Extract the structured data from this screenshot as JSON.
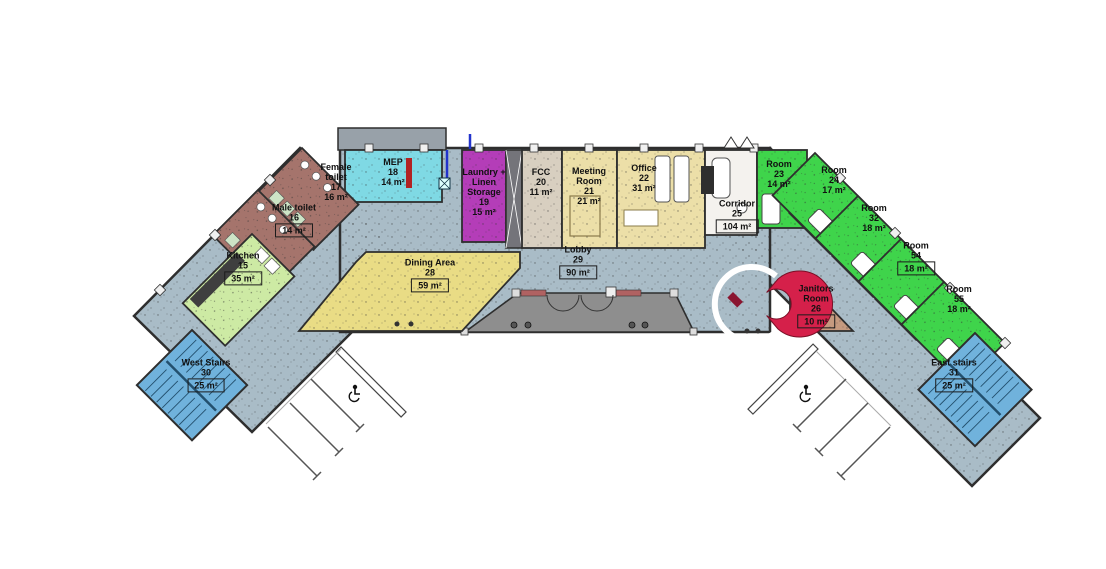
{
  "plan_type": "floor-plan",
  "rooms": [
    {
      "id": "kitchen",
      "lines": [
        "Kitchen",
        "15"
      ],
      "area": "35 m²",
      "area_boxed": true
    },
    {
      "id": "male-toilet",
      "lines": [
        "Male toilet",
        "16"
      ],
      "area": "14 m²",
      "area_boxed": true
    },
    {
      "id": "female-toilet",
      "lines": [
        "Female",
        "toilet",
        "17"
      ],
      "area": "16 m²",
      "area_boxed": false
    },
    {
      "id": "mep",
      "lines": [
        "MEP",
        "18"
      ],
      "area": "14 m²",
      "area_boxed": false
    },
    {
      "id": "laundry",
      "lines": [
        "Laundry +",
        "Linen",
        "Storage",
        "19"
      ],
      "area": "15 m²",
      "area_boxed": false
    },
    {
      "id": "fcc",
      "lines": [
        "FCC",
        "20"
      ],
      "area": "11 m²",
      "area_boxed": false
    },
    {
      "id": "meeting-room",
      "lines": [
        "Meeting",
        "Room",
        "21"
      ],
      "area": "21 m²",
      "area_boxed": false
    },
    {
      "id": "office",
      "lines": [
        "Office",
        "22"
      ],
      "area": "31 m²",
      "area_boxed": false
    },
    {
      "id": "room-23",
      "lines": [
        "Room",
        "23"
      ],
      "area": "14 m²",
      "area_boxed": false
    },
    {
      "id": "room-24",
      "lines": [
        "Room",
        "24"
      ],
      "area": "17 m²",
      "area_boxed": false
    },
    {
      "id": "room-32",
      "lines": [
        "Room",
        "32"
      ],
      "area": "18 m²",
      "area_boxed": false
    },
    {
      "id": "room-54",
      "lines": [
        "Room",
        "54"
      ],
      "area": "18 m²",
      "area_boxed": true
    },
    {
      "id": "room-55",
      "lines": [
        "Room",
        "55"
      ],
      "area": "18 m²",
      "area_boxed": false
    },
    {
      "id": "corridor",
      "lines": [
        "Corridor",
        "25"
      ],
      "area": "104 m²",
      "area_boxed": true
    },
    {
      "id": "janitors-room",
      "lines": [
        "Janitors",
        "Room",
        "26"
      ],
      "area": "10 m²",
      "area_boxed": true
    },
    {
      "id": "dining-area",
      "lines": [
        "Dining Area",
        "28"
      ],
      "area": "59 m²",
      "area_boxed": true
    },
    {
      "id": "lobby",
      "lines": [
        "Lobby",
        "29"
      ],
      "area": "90 m²",
      "area_boxed": true
    },
    {
      "id": "west-stairs",
      "lines": [
        "West Stairs",
        "30"
      ],
      "area": "25 m²",
      "area_boxed": true
    },
    {
      "id": "east-stairs",
      "lines": [
        "East stairs",
        "31"
      ],
      "area": "25 m²",
      "area_boxed": true
    }
  ],
  "parking": {
    "left_lot": {
      "stall_lines": 3,
      "accessible": true
    },
    "right_lot": {
      "stall_lines": 3,
      "accessible": true
    }
  },
  "colors": {
    "floor": "#a9bcc7",
    "dining": "#e9dc85",
    "office_zone": "#ecdfa8",
    "guest_room": "#3fd44b",
    "stairs": "#70b2dc",
    "toilet": "#a5746c",
    "kitchen": "#cdeaa4",
    "mep": "#7fd9e4",
    "laundry": "#b43db8",
    "janitor": "#c59a7f",
    "plaza": "#8e8e8e",
    "reception_desk": "#d5204a",
    "wall": "#2e2e2e"
  }
}
